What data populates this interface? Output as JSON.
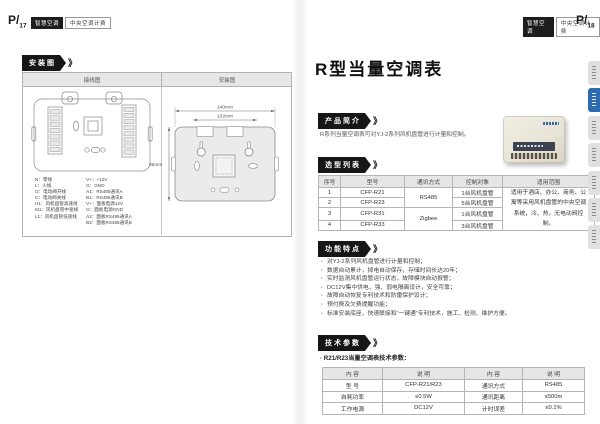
{
  "header": {
    "badge_dark": "智慧空调",
    "badge_light": "中央空调计费",
    "left_page_no": "P/",
    "left_page_num": "17",
    "right_page_no": "P/",
    "right_page_num": "18"
  },
  "left_page": {
    "section_tag": "安装图",
    "panel": {
      "col_headers": [
        "接线图",
        "安装图"
      ],
      "legend_left": [
        "N：零线",
        "L：火线",
        "O：电动阀开线",
        "C：电动阀关线",
        "H1：风机盘管高速线",
        "M1：风机盘管中速线",
        "L1：风机盘管低速线"
      ],
      "legend_right": [
        "V+：+12V",
        "G：GND",
        "A1：RS485通讯A",
        "B1：RS485通讯B",
        "V+：面板电源12V",
        "G：面板电源GND",
        "A2：面板RS485通讯A",
        "B2：面板RS485通讯B"
      ],
      "dim_width": "140mm",
      "dim_holes": "102mm",
      "dim_height": "86mm"
    }
  },
  "right_page": {
    "title": "R型当量空调表",
    "intro_tag": "产品简介",
    "intro_text": "R系列当量空调表可对YJ-2系列风机盘管进行计量和控制。",
    "selection_tag": "选型列表",
    "selection": {
      "headers": [
        "序号",
        "型号",
        "通讯方式",
        "控制对象",
        "适用范围"
      ],
      "rows": [
        {
          "no": "1",
          "model": "CFP-R21",
          "target": "1台风机盘管"
        },
        {
          "no": "2",
          "model": "CFP-R23",
          "target": "5台风机盘管"
        },
        {
          "no": "3",
          "model": "CFP-R31",
          "target": "1台风机盘管"
        },
        {
          "no": "4",
          "model": "CFP-R33",
          "target": "3台风机盘管"
        }
      ],
      "comm_groups": [
        "RS485",
        "Zigbee"
      ],
      "scope": "适用于酒店、办公、商务、公寓等采用风机盘管的中央空调系统，冷、热，无电动阀控制。"
    },
    "features_tag": "功能特点",
    "features": [
      "对YJ-2系列风机盘管进行计量和控制；",
      "数据自动累计，掉电自动保存，存储时间长达20年；",
      "实时监测风机盘管运行状态，故障模块自动报警；",
      "DC12V集中供电，强、弱电隔离设计，安全可靠；",
      "故障自动恢复专利技术和防雷保护设计；",
      "预付费及欠费提醒功能；",
      "标准安装底座，快速联接和“一键通”专利技术，施工、检测、维护方便。"
    ],
    "specs_tag": "技术参数",
    "specs_subtitle": "· R21/R23当量空调表技术参数：",
    "specs": {
      "headers": [
        "内  容",
        "说  明",
        "内  容",
        "说  明"
      ],
      "rows": [
        [
          "型  号",
          "CFP-R21/R23",
          "通讯方式",
          "RS485"
        ],
        [
          "自耗功率",
          "≤0.5W",
          "通讯距离",
          "≤500m"
        ],
        [
          "工作电源",
          "DC12V",
          "计时误差",
          "≤0.1%"
        ]
      ]
    }
  }
}
